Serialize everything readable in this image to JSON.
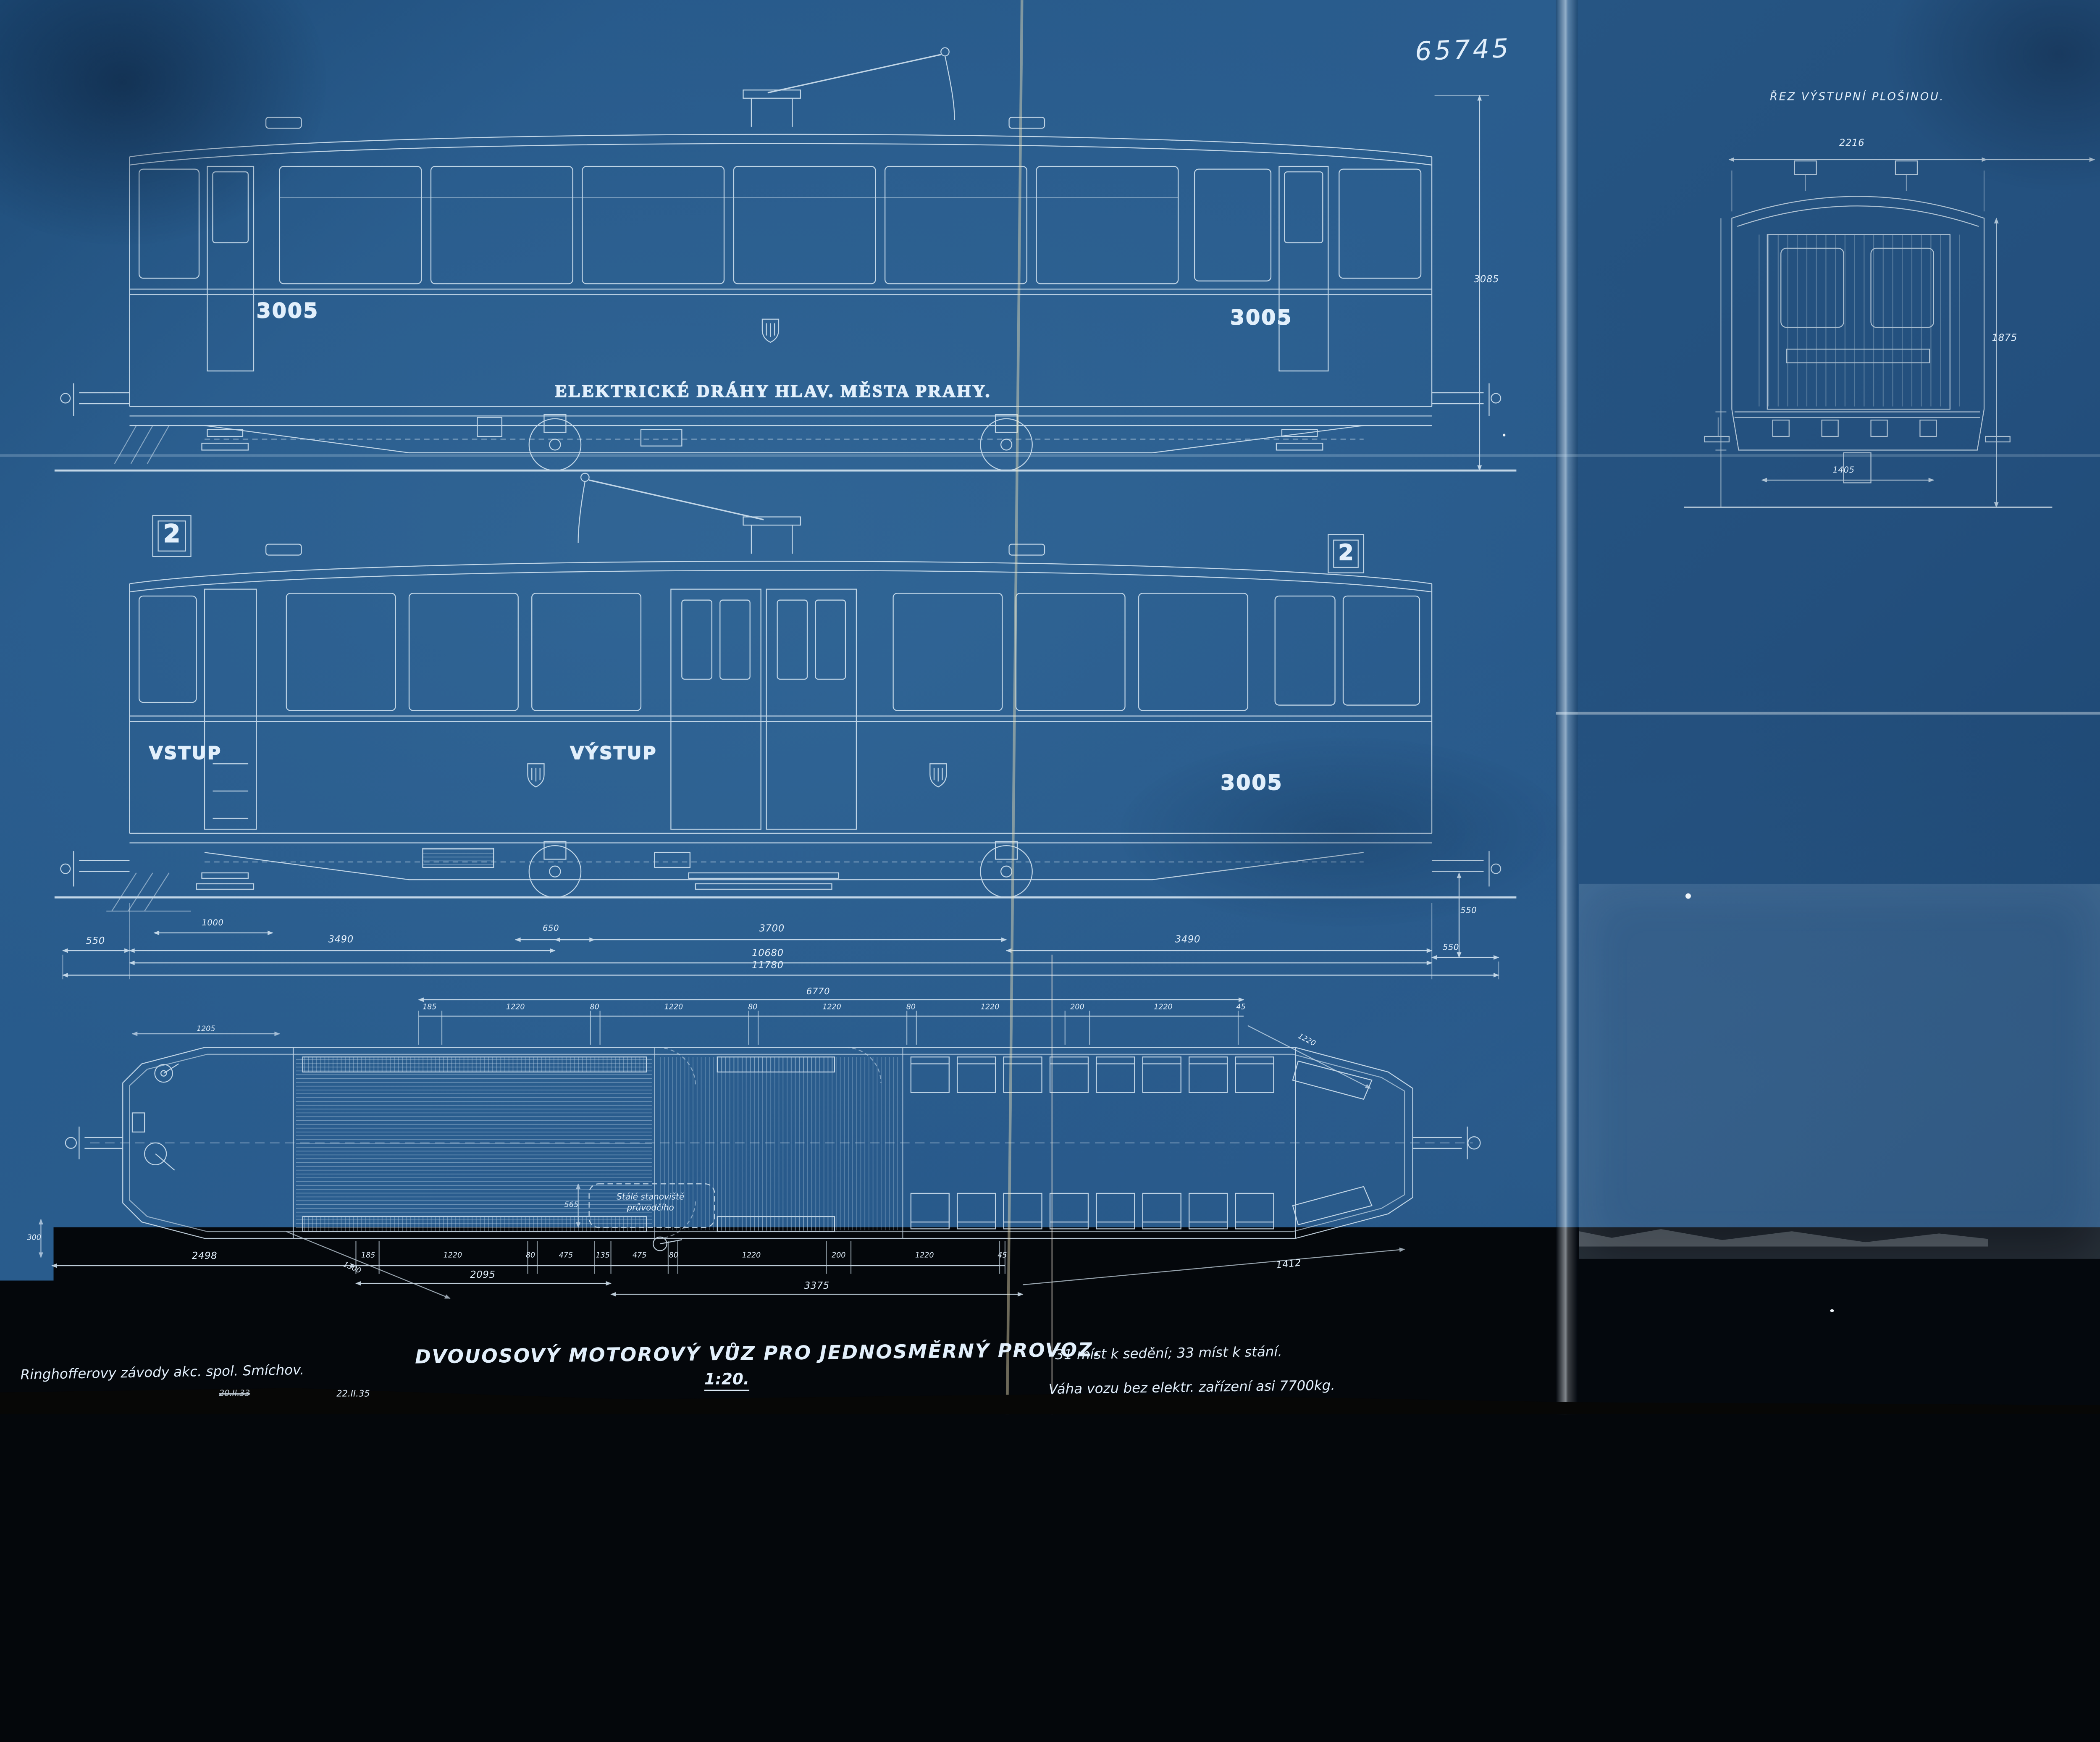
{
  "header": {
    "archive_number": "65745"
  },
  "side_elevation": {
    "car_number_left": "3005",
    "car_number_right": "3005",
    "lettering": "ELEKTRICKÉ DRÁHY HLAV. MĚSTA PRAHY.",
    "height_dim": "3085"
  },
  "platform_elevation": {
    "route_number_left": "2",
    "route_number_right": "2",
    "entrance_label": "VSTUP",
    "exit_label": "VÝSTUP",
    "car_number": "3005",
    "dims": {
      "step": "1000",
      "wheel": "650",
      "left_overhang": "3490",
      "axle_base": "3700",
      "right_overhang": "3490",
      "buffer_left": "550",
      "buffer_right": "550",
      "buffer_height": "550",
      "body_length": "10680",
      "overall_length": "11780"
    }
  },
  "cross_section": {
    "title": "ŘEZ VÝSTUPNÍ PLOŠINOU.",
    "width_top": "2216",
    "height_right": "1875",
    "width_bottom": "1405"
  },
  "plan": {
    "note_line1": "Stálé stanoviště",
    "note_line2": "průvodčího",
    "top_dims": [
      "185",
      "1220",
      "80",
      "1220",
      "80",
      "1220",
      "80",
      "1220",
      "200",
      "1220",
      "45"
    ],
    "top_total": "6770",
    "end_diagonal": "1220",
    "bottom_left_total": "2498",
    "bottom_dims": [
      "185",
      "1220",
      "80",
      "475",
      "135",
      "475",
      "80",
      "1220",
      "200",
      "1220",
      "45"
    ],
    "subtotal_left": "2095",
    "subtotal_right": "3375",
    "diagonal_left": "1300",
    "diagonal_right": "1412",
    "platform_dim": "1205",
    "conductor_dim": "565",
    "buffer_dim": "300"
  },
  "footer": {
    "maker": "Ringhofferovy závody akc. spol. Smíchov.",
    "date_struck": "20.II.33",
    "date": "22.II.35",
    "title": "DVOUOSOVÝ MOTOROVÝ VŮZ PRO JEDNOSMĚRNÝ PROVOZ.",
    "scale": "1:20.",
    "seats": "31 míst k sedění; 33 míst k stání.",
    "weight": "Váha vozu bez elektr. zařízení asi 7700kg."
  },
  "colors": {
    "paper": "#2a5d8e",
    "paper_dark": "#1d4a76",
    "line": "#d8e8f4",
    "crease": "#e8eef2"
  }
}
